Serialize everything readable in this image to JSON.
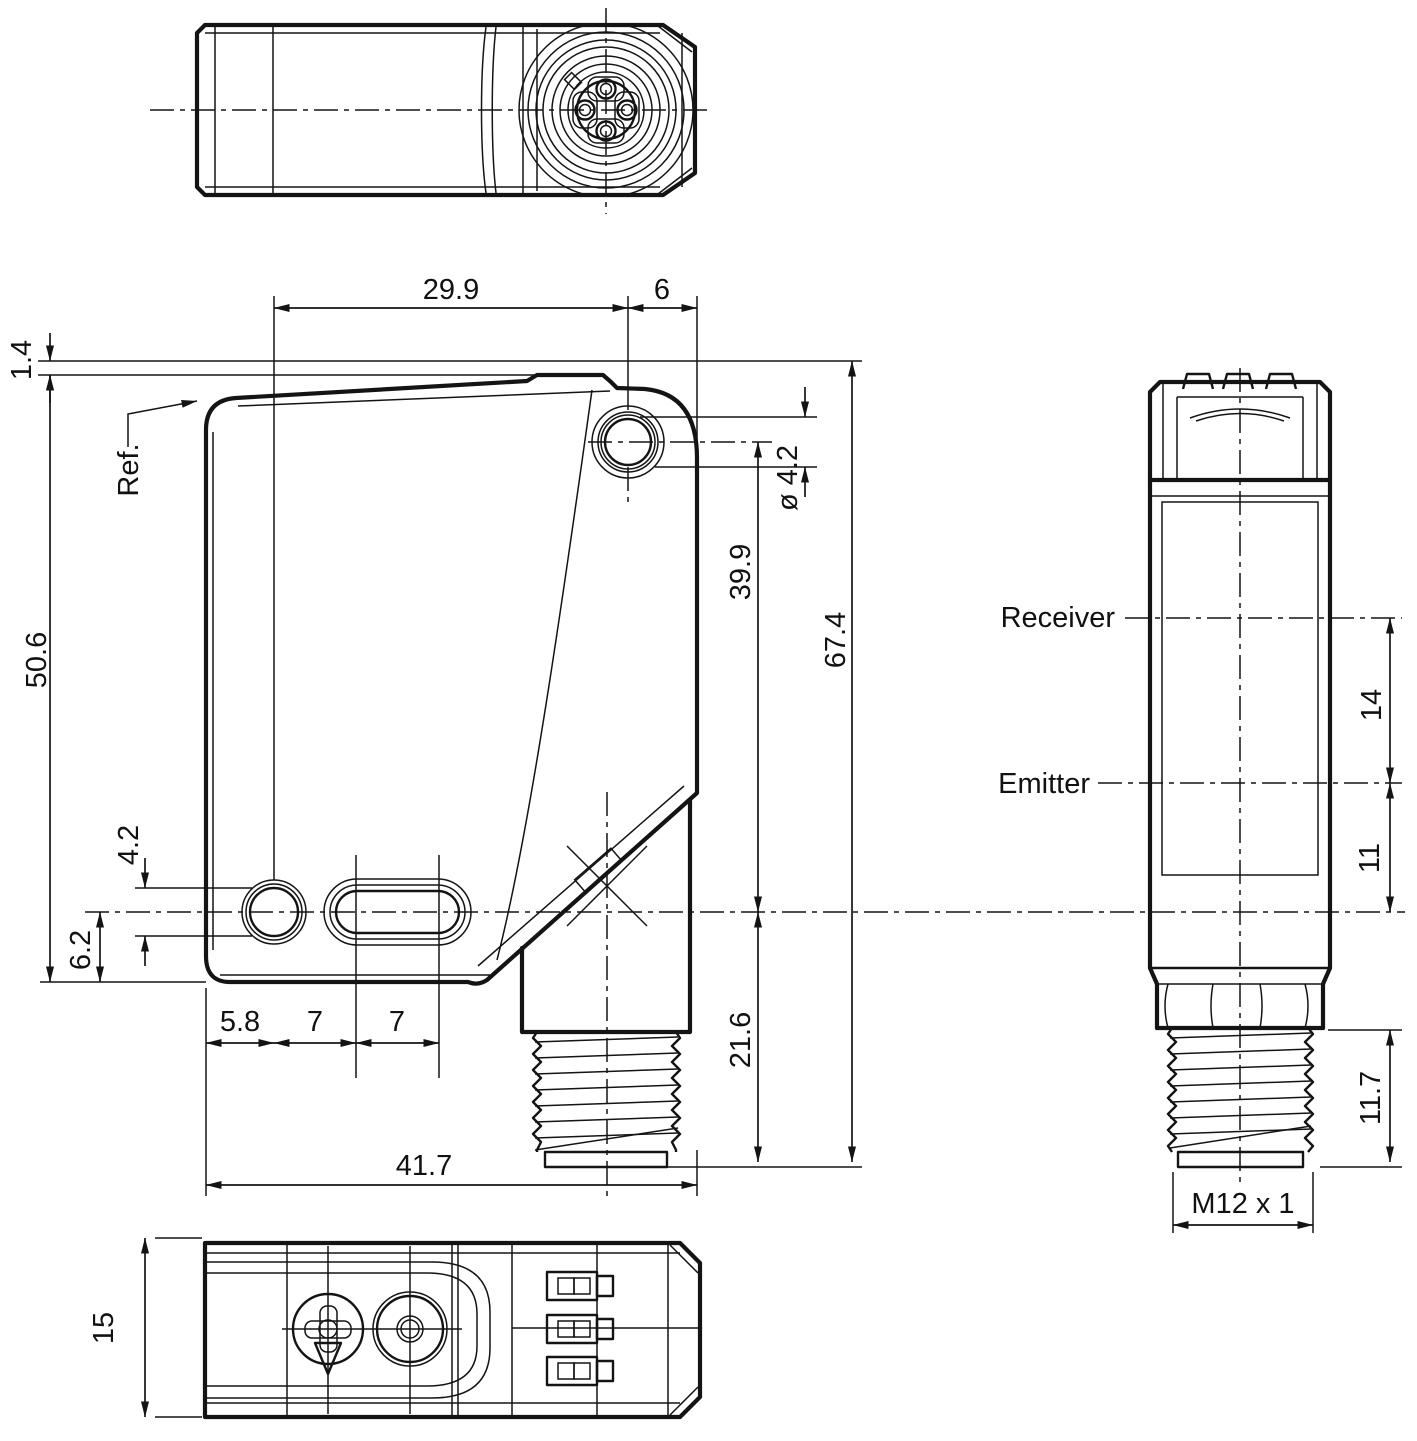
{
  "front_view": {
    "dim_hole_span": "29.9",
    "dim_hole_to_edge": "6",
    "dim_step_height": "1.4",
    "dim_body_height": "50.6",
    "dim_hole_diameter": "4.2",
    "dim_axis_height": "6.2",
    "dim_hole_offset": "5.8",
    "dim_pitch_a": "7",
    "dim_pitch_b": "7",
    "dim_body_width": "41.7",
    "dim_top_hole_diameter": "ø 4.2",
    "dim_hole_to_axis": "39.9",
    "dim_total_height": "67.4",
    "dim_connector_length": "21.6",
    "ref_label": "Ref."
  },
  "side_view": {
    "receiver_label": "Receiver",
    "emitter_label": "Emitter",
    "dim_receiver_to_emitter": "14",
    "dim_emitter_to_axis": "11",
    "dim_thread_length": "11.7",
    "thread_spec": "M12 x 1"
  },
  "bottom_view": {
    "dim_depth": "15"
  }
}
